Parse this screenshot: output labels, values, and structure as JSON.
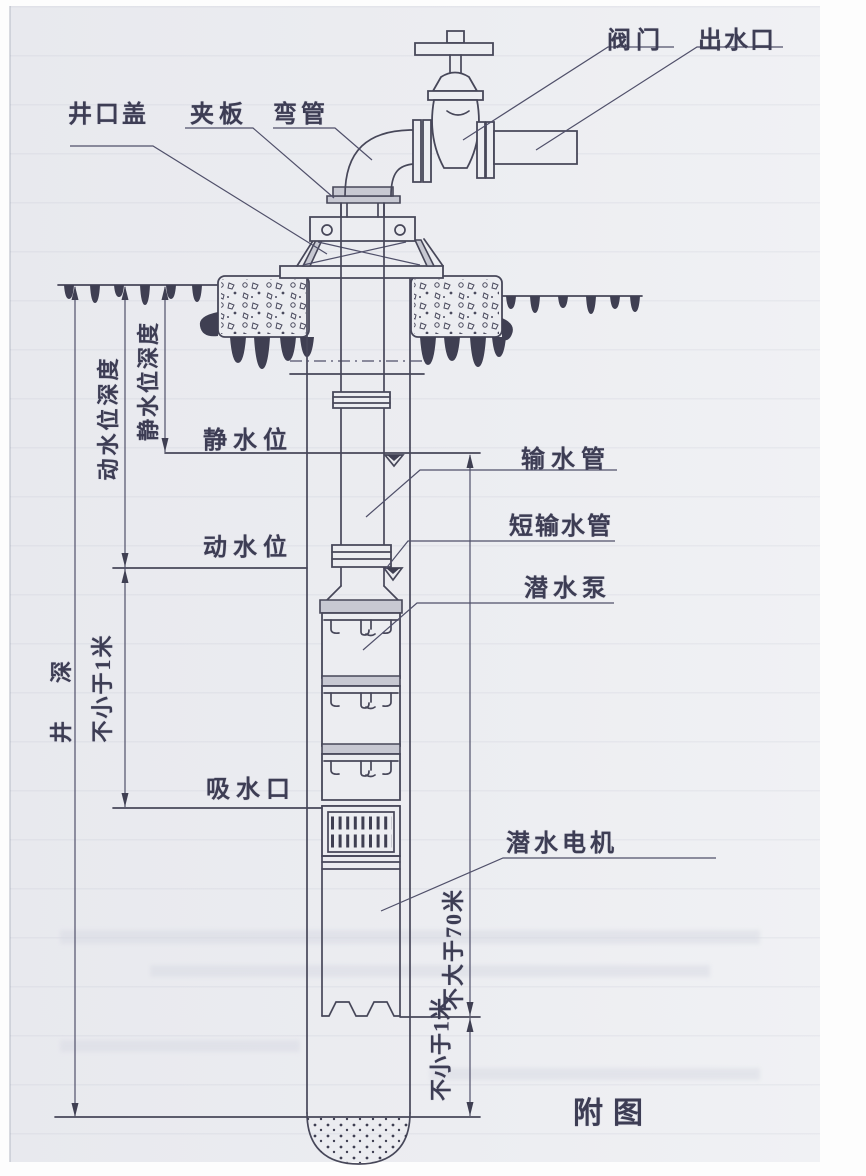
{
  "caption": "附图",
  "labels": {
    "valve": "阀门",
    "outlet": "出水口",
    "wellhead_cover": "井口盖",
    "clamp_plate": "夹板",
    "bend_pipe": "弯管",
    "static_water_level": "静水位",
    "dynamic_water_level": "动水位",
    "delivery_pipe": "输水管",
    "short_delivery_pipe": "短输水管",
    "submersible_pump": "潜水泵",
    "suction_inlet": "吸水口",
    "submersible_motor": "潜水电机"
  },
  "dimensions": {
    "well_depth": "井　深",
    "dynamic_level_depth": "动水位深度",
    "static_level_depth": "静水位深度",
    "min_1m_upper": "不小于1米",
    "max_70m": "不大于70米",
    "min_1m_bottom": "不小于1米"
  },
  "colors": {
    "paper": "#ecedf1",
    "ink": "#474759",
    "text": "#3d3d54"
  }
}
